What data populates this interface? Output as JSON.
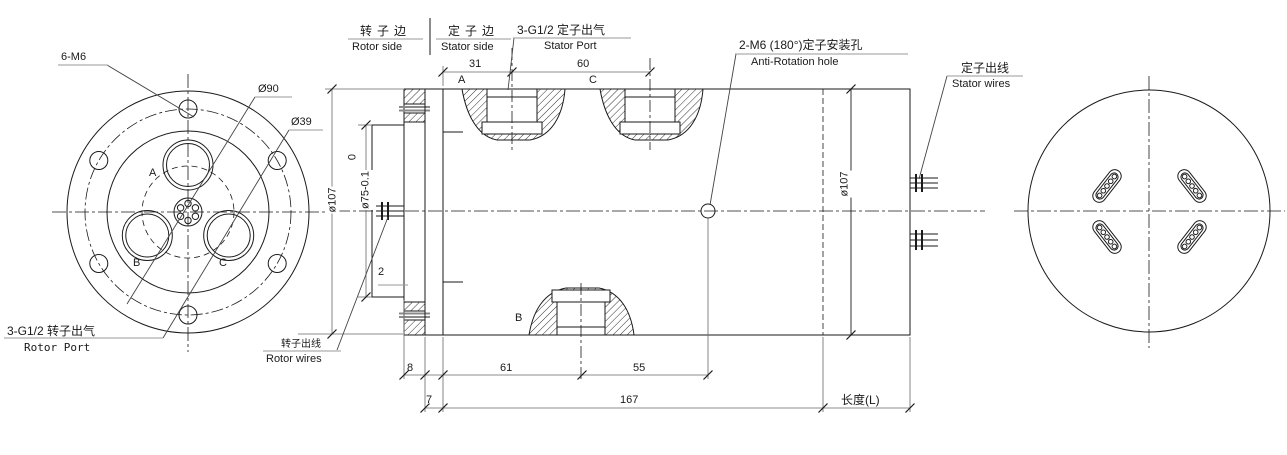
{
  "left_view": {
    "bolt_label": "6-M6",
    "dia90": "Ø90",
    "dia39": "Ø39",
    "port_a": "A",
    "port_b": "B",
    "port_c": "C",
    "rotor_port_cn": "3-G1/2 转子出气",
    "rotor_port_en": "Rotor Port"
  },
  "header": {
    "rotor_side_cn": "转子边",
    "rotor_side_en": "Rotor side",
    "stator_side_cn": "定子边",
    "stator_side_en": "Stator side"
  },
  "section_view": {
    "stator_port_cn": "3-G1/2 定子出气",
    "stator_port_en": "Stator Port",
    "anti_rotation_cn": "2-M6 (180°)定子安装孔",
    "anti_rotation_en": "Anti-Rotation hole",
    "stator_wires_cn": "定子出线",
    "stator_wires_en": "Stator wires",
    "rotor_wires_cn": "转子出线",
    "rotor_wires_en": "Rotor wires",
    "label_a": "A",
    "label_b": "B",
    "label_c": "C"
  },
  "dims": {
    "d31": "31",
    "d60": "60",
    "d107_left": "ø107",
    "d75_tol_top": "0",
    "d75": "ø75-0.1",
    "d2": "2",
    "d8": "8",
    "d7": "7",
    "d61": "61",
    "d55": "55",
    "d167": "167",
    "length_l": "长度(L)",
    "d107_right": "ø107"
  },
  "colors": {
    "line": "#1a1a1a",
    "dim": "#666666",
    "rule": "#999999",
    "background": "#ffffff"
  }
}
